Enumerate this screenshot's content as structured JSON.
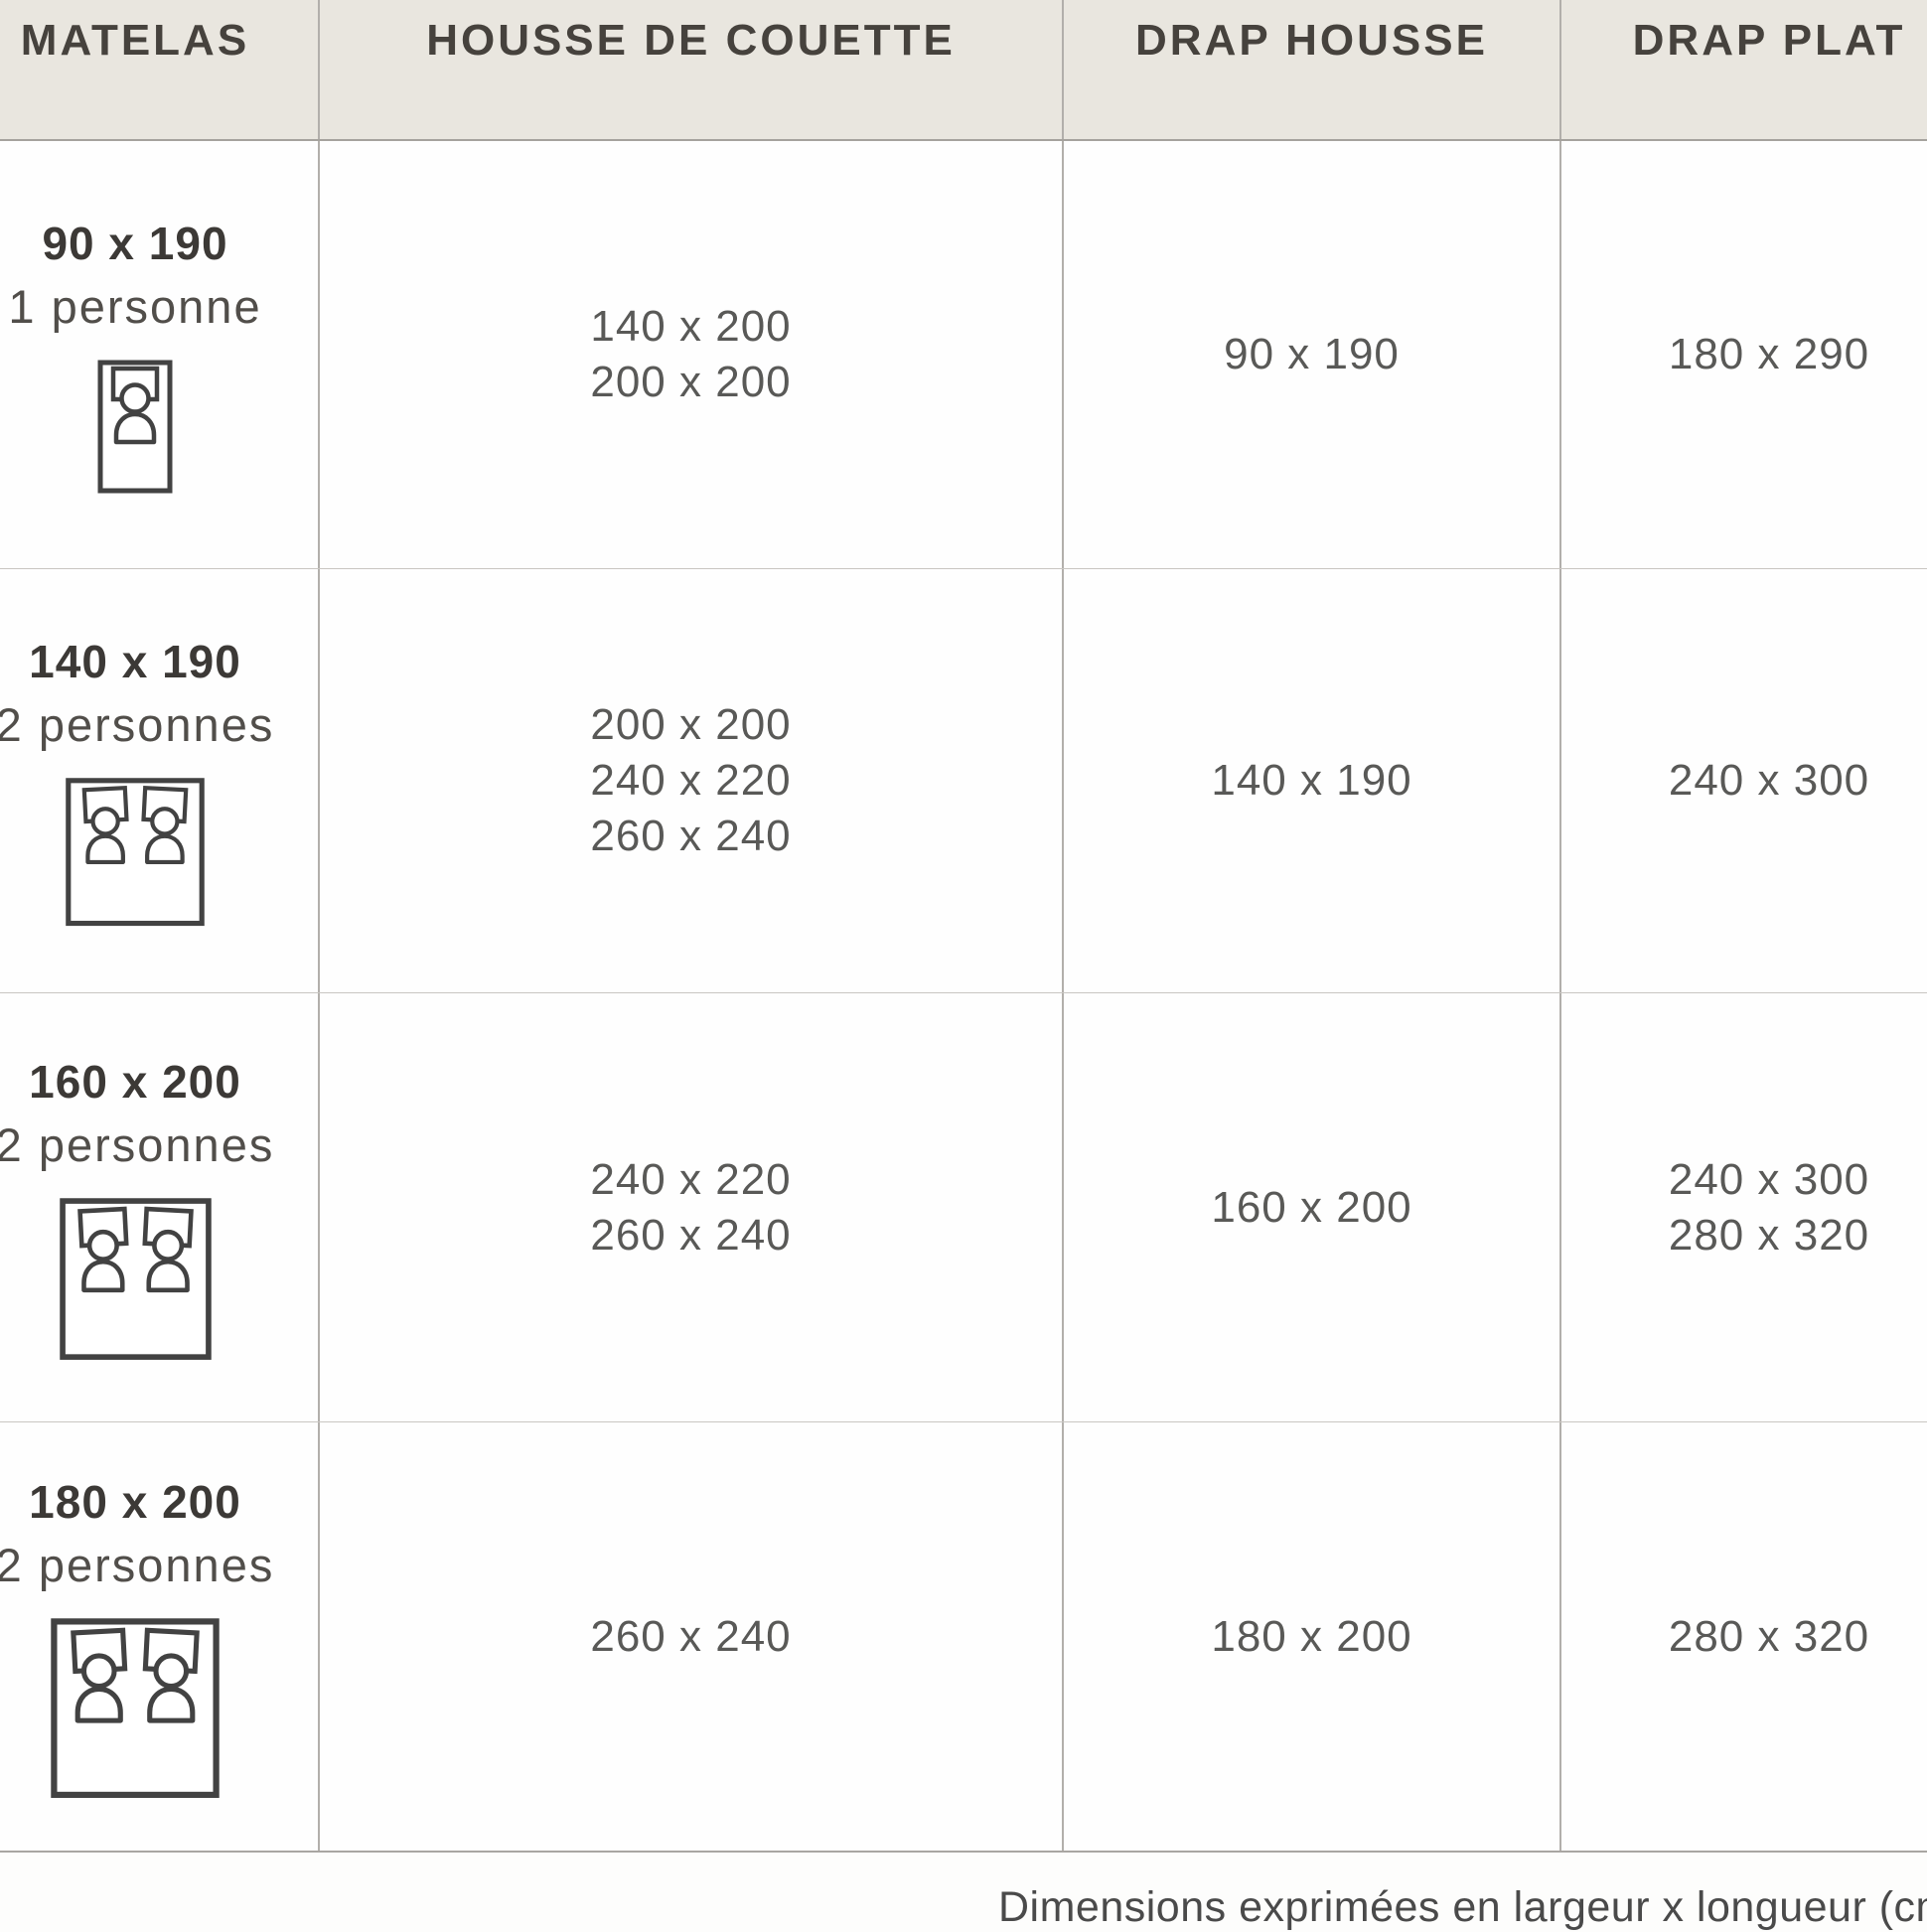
{
  "chart_data": {
    "type": "table",
    "columns": [
      "MATELAS",
      "HOUSSE DE COUETTE",
      "DRAP HOUSSE",
      "DRAP PLAT"
    ],
    "rows": [
      {
        "mattress_size": "90 x 190",
        "capacity": "1 personne",
        "bed_icon": "single-bed-icon",
        "duvet_cover_sizes": [
          "140 x 200",
          "200 x 200"
        ],
        "fitted_sheet_sizes": [
          "90 x 190"
        ],
        "flat_sheet_sizes": [
          "180 x 290"
        ]
      },
      {
        "mattress_size": "140 x 190",
        "capacity": "2 personnes",
        "bed_icon": "double-bed-icon",
        "duvet_cover_sizes": [
          "200 x 200",
          "240 x 220",
          "260 x 240"
        ],
        "fitted_sheet_sizes": [
          "140 x 190"
        ],
        "flat_sheet_sizes": [
          "240 x 300"
        ]
      },
      {
        "mattress_size": "160 x 200",
        "capacity": "2 personnes",
        "bed_icon": "double-bed-icon",
        "duvet_cover_sizes": [
          "240 x 220",
          "260 x 240"
        ],
        "fitted_sheet_sizes": [
          "160 x 200"
        ],
        "flat_sheet_sizes": [
          "240 x 300",
          "280 x 320"
        ]
      },
      {
        "mattress_size": "180 x 200",
        "capacity": "2 personnes",
        "bed_icon": "double-bed-icon",
        "duvet_cover_sizes": [
          "260 x 240"
        ],
        "fitted_sheet_sizes": [
          "180 x 200"
        ],
        "flat_sheet_sizes": [
          "280 x 320"
        ]
      }
    ],
    "footnote": "Dimensions exprimées en largeur x longueur (cm)",
    "layout_hints": "header row beige, body white, thin gray grid, table cropped at left/right edges"
  },
  "colors": {
    "header_bg": "#e9e6df",
    "header_text": "#46423d",
    "value_text": "#595957",
    "bold_text": "#3c3936",
    "grid_line": "#b2afab",
    "icon_stroke": "#424242"
  }
}
